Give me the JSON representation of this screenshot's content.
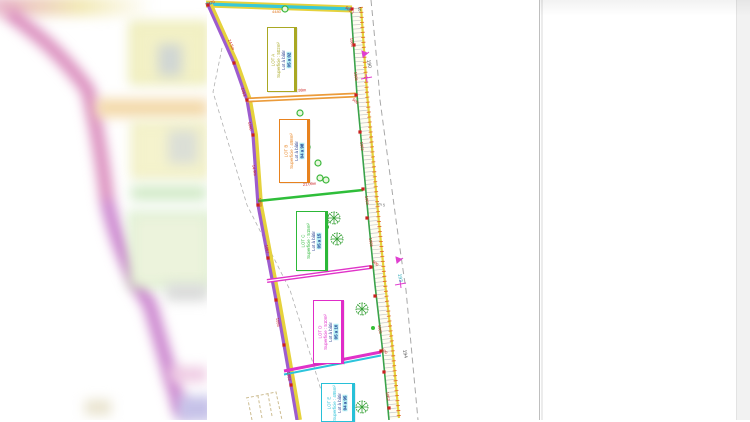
{
  "page": {
    "background": "#ffffff",
    "right_strip_color": "#f2f2f2",
    "paper_edge_x": 540
  },
  "plan": {
    "lots": [
      {
        "name": "LOT A",
        "area_label": "Superficie : 502m²",
        "status": "Lot à bâtir",
        "value": "05 a 02",
        "color": "#a9a823"
      },
      {
        "name": "LOT B",
        "area_label": "Superficie : 498m²",
        "status": "Lot à bâtir",
        "value": "04 a 98",
        "color": "#e8821e"
      },
      {
        "name": "LOT C",
        "area_label": "Superficie : 515m²",
        "status": "Lot à bâtir",
        "value": "05 a 15",
        "color": "#2cb838"
      },
      {
        "name": "LOT D",
        "area_label": "Superficie : 510m²",
        "status": "Lot à bâtir",
        "value": "05 a 10",
        "color": "#e02cc8"
      },
      {
        "name": "LOT E",
        "area_label": "Superficie : 495m²",
        "status": "Lot à bâtir",
        "value": "04 a 95",
        "color": "#28c0d8"
      }
    ],
    "annotations": [
      {
        "x": 206,
        "y": 6,
        "t": "N470",
        "r": -20,
        "c": "#cc2020"
      },
      {
        "x": 272,
        "y": 13,
        "t": "4480",
        "r": 0,
        "c": "#e07820"
      },
      {
        "x": 345,
        "y": 8,
        "t": "500,1",
        "r": 40,
        "c": "#cc2020"
      },
      {
        "x": 358,
        "y": 7,
        "t": "10",
        "r": 85,
        "c": "#444444"
      },
      {
        "x": 228,
        "y": 40,
        "t": "24.5m",
        "r": 68,
        "c": "#cc2020"
      },
      {
        "x": 241,
        "y": 88,
        "t": "1063",
        "r": 75,
        "c": "#cc2020"
      },
      {
        "x": 248,
        "y": 122,
        "t": "1060",
        "r": 78,
        "c": "#cc2020"
      },
      {
        "x": 252,
        "y": 165,
        "t": "14.9m",
        "r": 80,
        "c": "#cc2020"
      },
      {
        "x": 258,
        "y": 198,
        "t": "1059",
        "r": 80,
        "c": "#cc2020"
      },
      {
        "x": 265,
        "y": 245,
        "t": "1057",
        "r": 80,
        "c": "#cc2020"
      },
      {
        "x": 276,
        "y": 318,
        "t": "1055",
        "r": 82,
        "c": "#cc2020"
      },
      {
        "x": 287,
        "y": 372,
        "t": "1053",
        "r": 82,
        "c": "#cc2020"
      },
      {
        "x": 293,
        "y": 92,
        "t": "27.99m",
        "r": -3,
        "c": "#cc2020"
      },
      {
        "x": 303,
        "y": 186,
        "t": "21.09m",
        "r": -6,
        "c": "#cc2020"
      },
      {
        "x": 308,
        "y": 264,
        "t": "25.87m",
        "r": -8,
        "c": "#cc2020"
      },
      {
        "x": 322,
        "y": 352,
        "t": "13.40m",
        "r": -12,
        "c": "#cc2020"
      },
      {
        "x": 350,
        "y": 38,
        "t": "1064",
        "r": 82,
        "c": "#cc2020"
      },
      {
        "x": 354,
        "y": 72,
        "t": "1066",
        "r": 82,
        "c": "#cc2020"
      },
      {
        "x": 352,
        "y": 100,
        "t": "500",
        "r": 40,
        "c": "#cc2020"
      },
      {
        "x": 360,
        "y": 142,
        "t": "1062",
        "r": 82,
        "c": "#cc2020"
      },
      {
        "x": 365,
        "y": 196,
        "t": "1063",
        "r": 82,
        "c": "#cc2020"
      },
      {
        "x": 369,
        "y": 238,
        "t": "1068",
        "r": 82,
        "c": "#cc2020"
      },
      {
        "x": 372,
        "y": 262,
        "t": "500",
        "r": 40,
        "c": "#cc2020"
      },
      {
        "x": 378,
        "y": 325,
        "t": "1065",
        "r": 83,
        "c": "#cc2020"
      },
      {
        "x": 381,
        "y": 350,
        "t": "500",
        "r": 40,
        "c": "#cc2020"
      },
      {
        "x": 386,
        "y": 392,
        "t": "1062",
        "r": 83,
        "c": "#cc2020"
      },
      {
        "x": 367,
        "y": 60,
        "t": "190",
        "r": 80,
        "c": "#555555",
        "s": 5
      },
      {
        "x": 377,
        "y": 205,
        "t": "rm 5",
        "r": 12,
        "c": "#666666"
      },
      {
        "x": 398,
        "y": 274,
        "t": "193",
        "r": 80,
        "c": "#2aa8b8",
        "s": 5
      },
      {
        "x": 403,
        "y": 350,
        "t": "194",
        "r": 80,
        "c": "#555555",
        "s": 5
      }
    ],
    "survey_points": [
      [
        208,
        5
      ],
      [
        352,
        9
      ],
      [
        234,
        63
      ],
      [
        247,
        100
      ],
      [
        253,
        135
      ],
      [
        258,
        205
      ],
      [
        268,
        258
      ],
      [
        276,
        300
      ],
      [
        284,
        345
      ],
      [
        291,
        385
      ],
      [
        356,
        95
      ],
      [
        363,
        189
      ],
      [
        371,
        267
      ],
      [
        381,
        351
      ],
      [
        354,
        45
      ],
      [
        360,
        132
      ],
      [
        367,
        218
      ],
      [
        375,
        296
      ],
      [
        384,
        372
      ],
      [
        389,
        408
      ]
    ],
    "trees": [
      {
        "x": 285,
        "y": 9,
        "r": 3,
        "type": "small"
      },
      {
        "x": 300,
        "y": 113,
        "r": 3,
        "type": "small"
      },
      {
        "x": 307,
        "y": 147,
        "r": 3,
        "type": "small"
      },
      {
        "x": 318,
        "y": 163,
        "r": 3,
        "type": "small"
      },
      {
        "x": 320,
        "y": 178,
        "r": 3,
        "type": "small"
      },
      {
        "x": 326,
        "y": 180,
        "r": 3,
        "type": "small"
      },
      {
        "x": 324,
        "y": 219,
        "r": 6,
        "type": "star"
      },
      {
        "x": 334,
        "y": 218,
        "r": 6,
        "type": "star"
      },
      {
        "x": 337,
        "y": 239,
        "r": 6,
        "type": "star"
      },
      {
        "x": 362,
        "y": 309,
        "r": 6,
        "type": "star"
      },
      {
        "x": 362,
        "y": 407,
        "r": 6,
        "type": "star"
      },
      {
        "x": 373,
        "y": 328,
        "r": 2,
        "type": "dot"
      },
      {
        "x": 327,
        "y": 227,
        "r": 2,
        "type": "dot"
      }
    ],
    "colors": {
      "top_edge": "#38c8d8",
      "left_edge": "#9d5cce",
      "edge_yellow": "#e6d23c",
      "divider_ab": "#eb9b3a",
      "divider_bc": "#2fbe3a",
      "divider_cd": "#e032c8",
      "divider_de_magenta": "#e032c8",
      "divider_de_cyan": "#2cc4dc",
      "road_hatch": "#c0c0c0",
      "road_tick": "#e06428",
      "road_green": "#3aa34a",
      "survey_point": "#cc2020",
      "marker": "#e040d0",
      "dashed_line": "#a8a8a8"
    }
  }
}
